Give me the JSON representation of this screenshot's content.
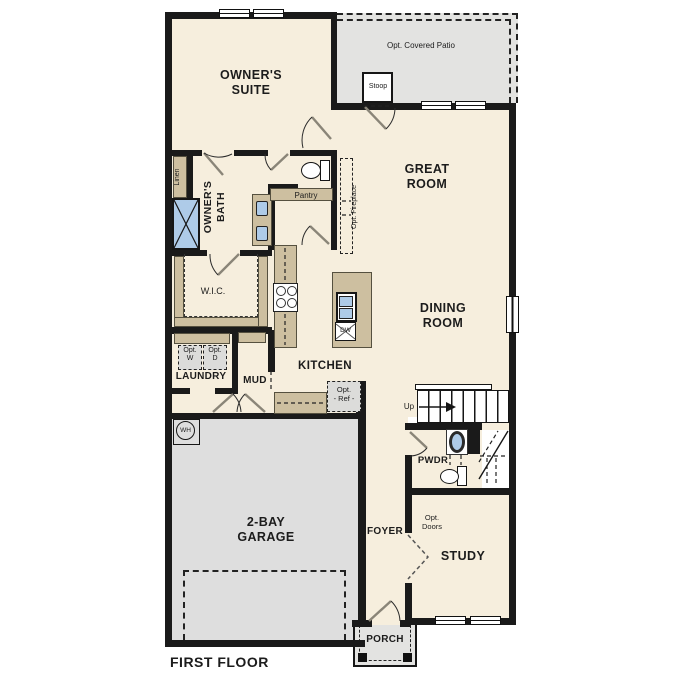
{
  "title": "FIRST FLOOR",
  "rooms": {
    "owners_suite": "OWNER'S\nSUITE",
    "great_room": "GREAT\nROOM",
    "dining_room": "DINING\nROOM",
    "kitchen": "KITCHEN",
    "owners_bath": "OWNER'S\nBATH",
    "wic": "W.I.C.",
    "laundry": "LAUNDRY",
    "mud": "MUD",
    "garage": "2-BAY\nGARAGE",
    "foyer": "FOYER",
    "pwdr": "PWDR",
    "study": "STUDY",
    "porch": "PORCH"
  },
  "annotations": {
    "covered_patio": "Opt. Covered Patio",
    "stoop": "Stoop",
    "linen": "Linen",
    "pantry": "Pantry",
    "opt_fireplace": "Opt. Fireplace",
    "opt_w": "Opt.\nW",
    "opt_d": "Opt.\nD",
    "opt_ref": "Opt.\n- Ref -",
    "opt_doors": "Opt.\nDoors",
    "up": "Up",
    "wh": "WH",
    "dw": "DW"
  },
  "colors": {
    "floor": "#f6eedd",
    "patio": "#e3e3e1",
    "garage_floor": "#dedede",
    "cabinet": "#cdbfa0",
    "fixture_blue": "#aecbe8",
    "wall": "#1a1a1a"
  }
}
